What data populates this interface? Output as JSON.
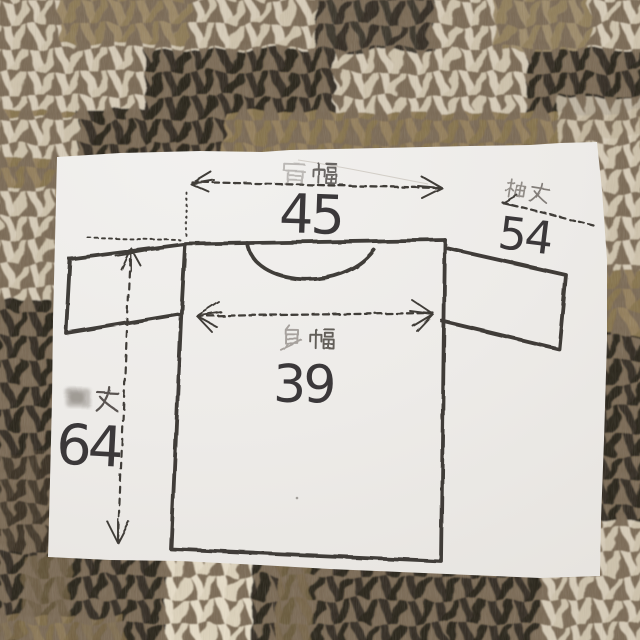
{
  "photo": {
    "subject": "size-measurement paper tag lying on a knitted wool sweater",
    "colors": {
      "paper": "#efedea",
      "ink": "#2f2b27",
      "stamp_grey": "#55504a",
      "wool_cream": "#d8cebb",
      "wool_brown": "#93805f",
      "wool_dark": "#352e25"
    }
  },
  "diagram": {
    "shoulder_width": {
      "label": "肩幅",
      "value": "45"
    },
    "sleeve_length": {
      "label": "袖丈",
      "value": "54"
    },
    "body_width": {
      "label": "身幅",
      "value": "39"
    },
    "garment_length": {
      "label": "着丈",
      "value": "64"
    }
  }
}
